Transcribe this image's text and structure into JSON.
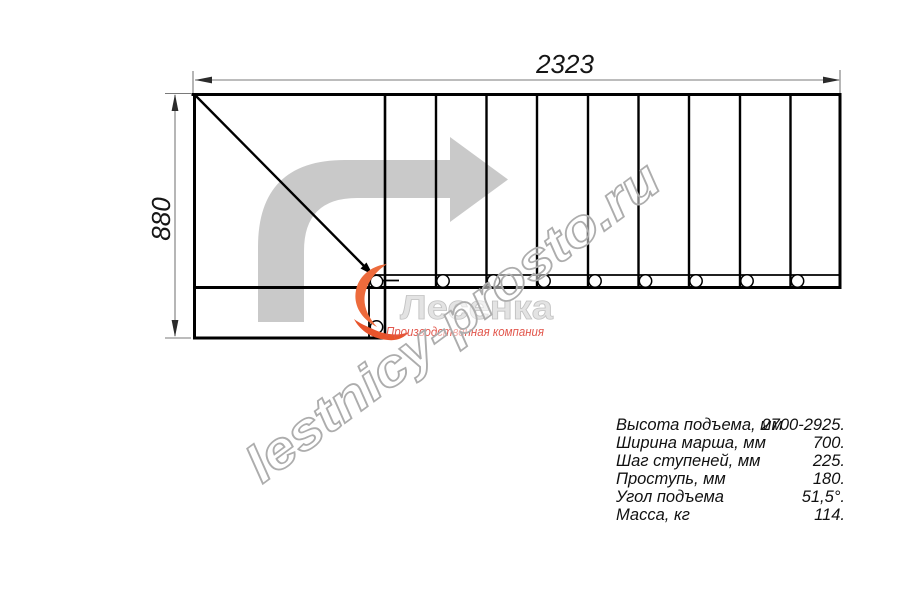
{
  "drawing": {
    "width_label": "2323",
    "height_label": "880"
  },
  "logo": {
    "name": "Лесенка",
    "tagline": "Производственная компания",
    "accent_color": "#ed6b3c",
    "tagline_color": "#e2574d"
  },
  "watermark": "lestnicy-prosto.ru",
  "specs": {
    "rows": [
      {
        "label": "Высота подъема, мм",
        "value": "2700-2925."
      },
      {
        "label": "Ширина марша, мм",
        "value": "700."
      },
      {
        "label": "Шаг ступеней, мм",
        "value": "225."
      },
      {
        "label": "Проступь, мм",
        "value": "180."
      },
      {
        "label": "Угол подъема",
        "value": "51,5°."
      },
      {
        "label": "Масса, кг",
        "value": "114."
      }
    ]
  },
  "colors": {
    "line": "#000000",
    "dimension": "#7a7a7a",
    "arrow_fill": "#c9c9c9",
    "watermark_stroke": "#adadad",
    "logo_text": "#e3e3e3"
  }
}
